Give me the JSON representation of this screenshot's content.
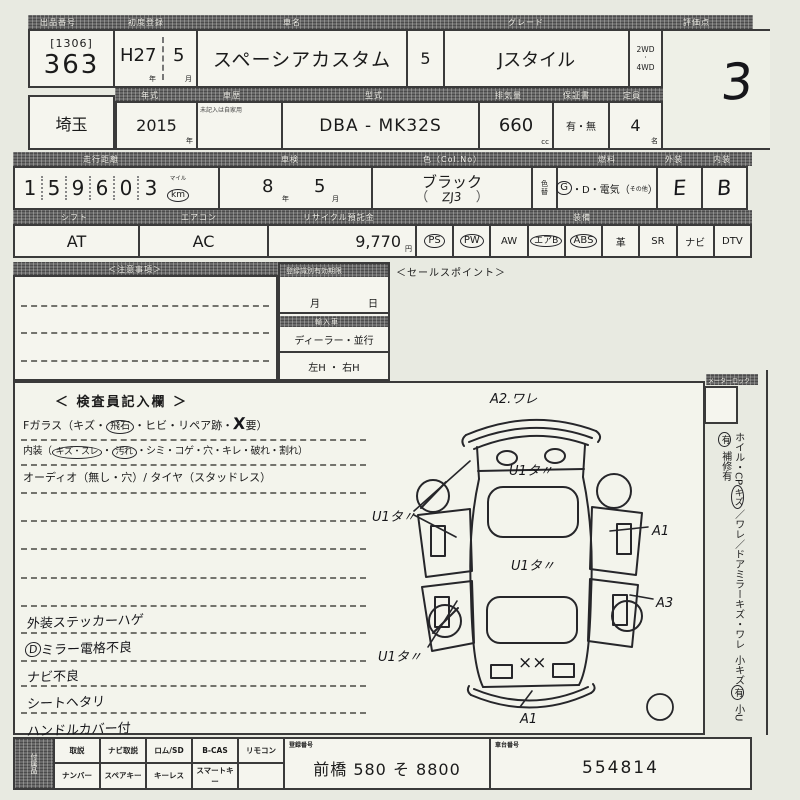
{
  "colors": {
    "paper": "#e8eae1",
    "cell": "#f5f5ee",
    "line": "#3a3a3a",
    "header_bg": "#6a6a6a",
    "header_text": "#f0efe8",
    "ink": "#1b1b1b"
  },
  "units": {
    "year": "年",
    "month": "月",
    "day": "日",
    "cc": "cc",
    "persons": "名",
    "yen": "円",
    "mile": "マイル",
    "km": "km"
  },
  "top": {
    "r1": {
      "lot_header": "出品番号",
      "lot_code": "[1306]",
      "lot_no": "363",
      "firstreg_header": "初度登録",
      "firstreg_year": "H27",
      "firstreg_month": "5",
      "name_header": "車名",
      "car_name": "スペーシアカスタム",
      "doors": "5",
      "grade_header": "グレード",
      "grade": "Jスタイル",
      "drive_a": "2WD",
      "drive_dot": "・",
      "drive_b": "4WD",
      "score_header": "評価点",
      "score": "3"
    },
    "r2": {
      "region": "埼玉",
      "year_header": "年式",
      "year": "2015",
      "history_header": "車歴",
      "history_note": "未記入は自家用",
      "model_header": "型式",
      "model": "DBA - MK32S",
      "disp_header": "排気量",
      "disp": "660",
      "warranty_header": "保証書",
      "warranty": "有・無",
      "capacity_header": "定員",
      "capacity": "4"
    },
    "r3": {
      "odo_header": "走行距離",
      "odo": [
        "1",
        "5",
        "9",
        "6",
        "0",
        "3"
      ],
      "shaken_header": "車検",
      "shaken_year": "8",
      "shaken_month": "5",
      "color_header": "色（Col.No）",
      "color": "ブラック",
      "color_code": "ZJ3",
      "paren_open": "（",
      "paren_close": "）",
      "colorchg_header": "色替",
      "fuel_header": "燃料",
      "fuel_g": "G",
      "fuel_mid": "・D・電気（",
      "fuel_other": "その他",
      "fuel_close": "）",
      "ext_header": "外装",
      "ext": "E",
      "int_header": "内装",
      "int": "B"
    },
    "r4": {
      "shift_header": "シフト",
      "shift": "AT",
      "ac_header": "エアコン",
      "ac": "AC",
      "recycle_header": "リサイクル預託金",
      "recycle": "9,770",
      "equip_header": "装備",
      "equipment": [
        {
          "label": "PS",
          "circled": true
        },
        {
          "label": "PW",
          "circled": true
        },
        {
          "label": "AW",
          "circled": false
        },
        {
          "label": "エアB",
          "circled": true
        },
        {
          "label": "ABS",
          "circled": true
        },
        {
          "label": "革",
          "circled": false
        },
        {
          "label": "SR",
          "circled": false
        },
        {
          "label": "ナビ",
          "circled": false
        },
        {
          "label": "DTV",
          "circled": false
        }
      ]
    }
  },
  "middle": {
    "notice_header": "＜注意事項＞",
    "validity_header": "登録識別有効期限",
    "import_header": "輸入車",
    "import_type": "ディーラー・並行",
    "handle": "左H ・ 右H",
    "sales_header": "＜セールスポイント＞"
  },
  "inspector": {
    "title": "＜ 検査員記入欄 ＞",
    "glass_pre": "Fガラス（キズ・",
    "glass_circled": "飛石",
    "glass_mid": "・ヒビ・リペア跡・",
    "glass_x": "X",
    "glass_post": "要）",
    "interior_pre": "内装（",
    "interior_c1": "キズ・スレ",
    "interior_dot": "・",
    "interior_c2": "汚れ",
    "interior_post": "・シミ・コゲ・穴・キレ・破れ・割れ）",
    "audio_line": "オーディオ（無し・穴）/ タイヤ（スタッドレス）",
    "notes": [
      {
        "text": "外装ステッカーハゲ"
      },
      {
        "prefix": "D",
        "text": "ミラー電格不良"
      },
      {
        "text": "ナビ不良"
      },
      {
        "text": "シートヘタリ"
      },
      {
        "text": "ハンドルカバー付"
      }
    ]
  },
  "diagram": {
    "a2": "A2.ワレ",
    "u1_hood": "U1タ〃",
    "u1_roof": "U1タ〃",
    "u1_left": "U1タ〃",
    "u1_rear": "U1タ〃",
    "a1_right": "A1",
    "a3": "A3",
    "a1_bottom": "A1",
    "xx": "××"
  },
  "right_col": {
    "meter_header": "メーターロック",
    "w1": "ホイル・CP",
    "w1c": "キズ",
    "w2": "／ワレ",
    "w3": "／ドアミラーキズ・ワレ",
    "w4": "小キズ",
    "w4c": "有",
    "w5": "小U",
    "w5c": "有",
    "w6": "補修有"
  },
  "bottom": {
    "acc_header": "付属品",
    "row1": [
      "取説",
      "ナビ取説",
      "ロム/SD",
      "B-CAS",
      "リモコン"
    ],
    "row2": [
      "ナンバー",
      "スペアキー",
      "キーレス",
      "スマートキー",
      ""
    ],
    "regno_header": "登録番号",
    "regno": "前橋 580 そ 8800",
    "chassis_header": "車台番号",
    "chassis": "554814"
  }
}
